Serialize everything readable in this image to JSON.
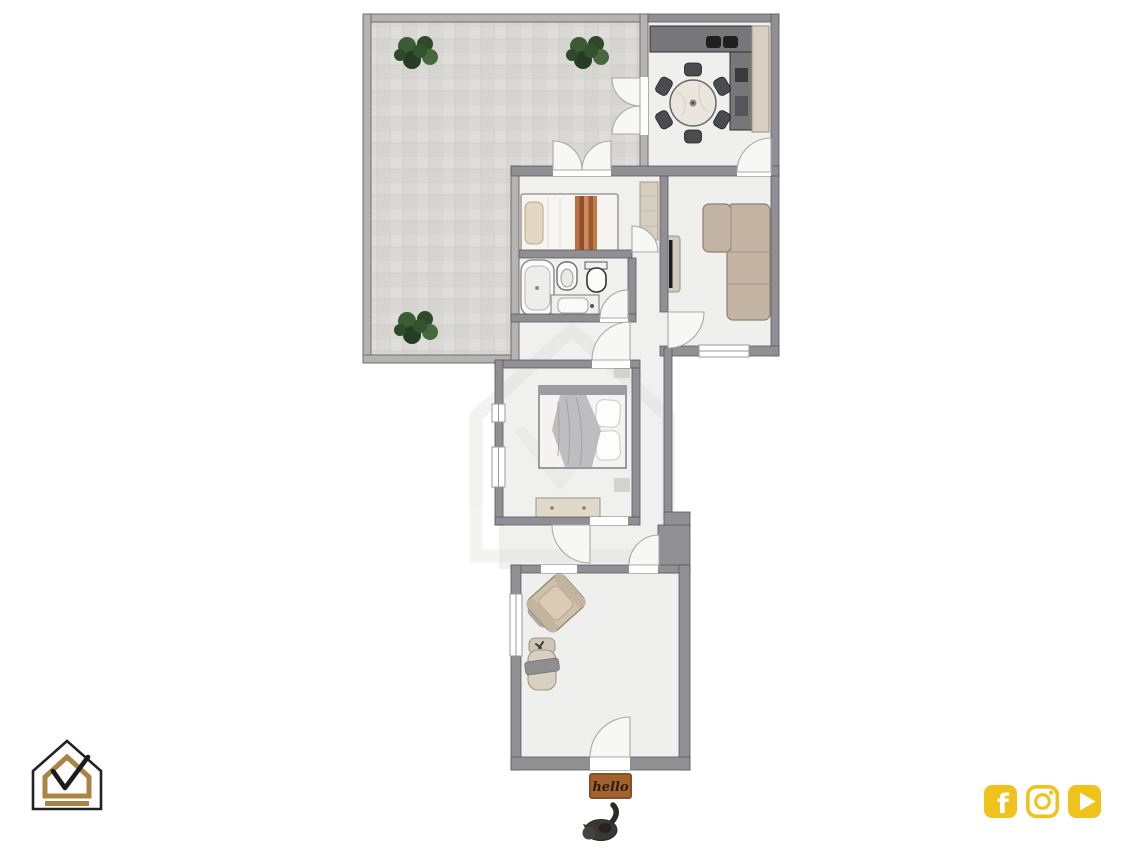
{
  "page": {
    "background": "#ffffff"
  },
  "floorplan": {
    "doormat": {
      "text": "hello",
      "mat_color": "#a2622e",
      "text_color": "#2e1c10"
    },
    "palette": {
      "interior_wall": "#8f8f94",
      "terrace_wall": "#b5b4b2",
      "room_floor": "#efefed",
      "terrace_tile": "#d9d8d4",
      "sofa_beige": "#c3b4a4",
      "counter_gray": "#77777a",
      "plant_green": "#35522f",
      "bed_runner_orange": "#b96f41"
    },
    "rooms": [
      {
        "name": "terrace",
        "features": [
          "tiled-floor",
          "plant",
          "plant",
          "plant",
          "french-doors"
        ]
      },
      {
        "name": "kitchen-dining",
        "features": [
          "kitchen-counter",
          "double-sink",
          "tall-cabinet",
          "round-dining-table",
          "six-chairs"
        ]
      },
      {
        "name": "living-room",
        "features": [
          "corner-sofa",
          "tv-on-stand",
          "window"
        ]
      },
      {
        "name": "small-bedroom",
        "features": [
          "single-bed",
          "wardrobe"
        ]
      },
      {
        "name": "bathroom",
        "features": [
          "bathtub",
          "bidet",
          "toilet",
          "washbasin-vanity"
        ]
      },
      {
        "name": "main-bedroom",
        "features": [
          "double-bed",
          "dresser",
          "windows"
        ]
      },
      {
        "name": "entry-room",
        "features": [
          "armchair",
          "lounge-chair",
          "entry-door"
        ]
      }
    ],
    "decor": {
      "cat": "black-cat-figurine"
    }
  },
  "branding": {
    "logo": {
      "icon": "house-check-logo",
      "gold": "#ab8443",
      "outline": "#232327"
    },
    "social": {
      "accent": "#f0c31c",
      "icons": [
        "facebook-icon",
        "instagram-icon",
        "youtube-icon"
      ]
    }
  }
}
